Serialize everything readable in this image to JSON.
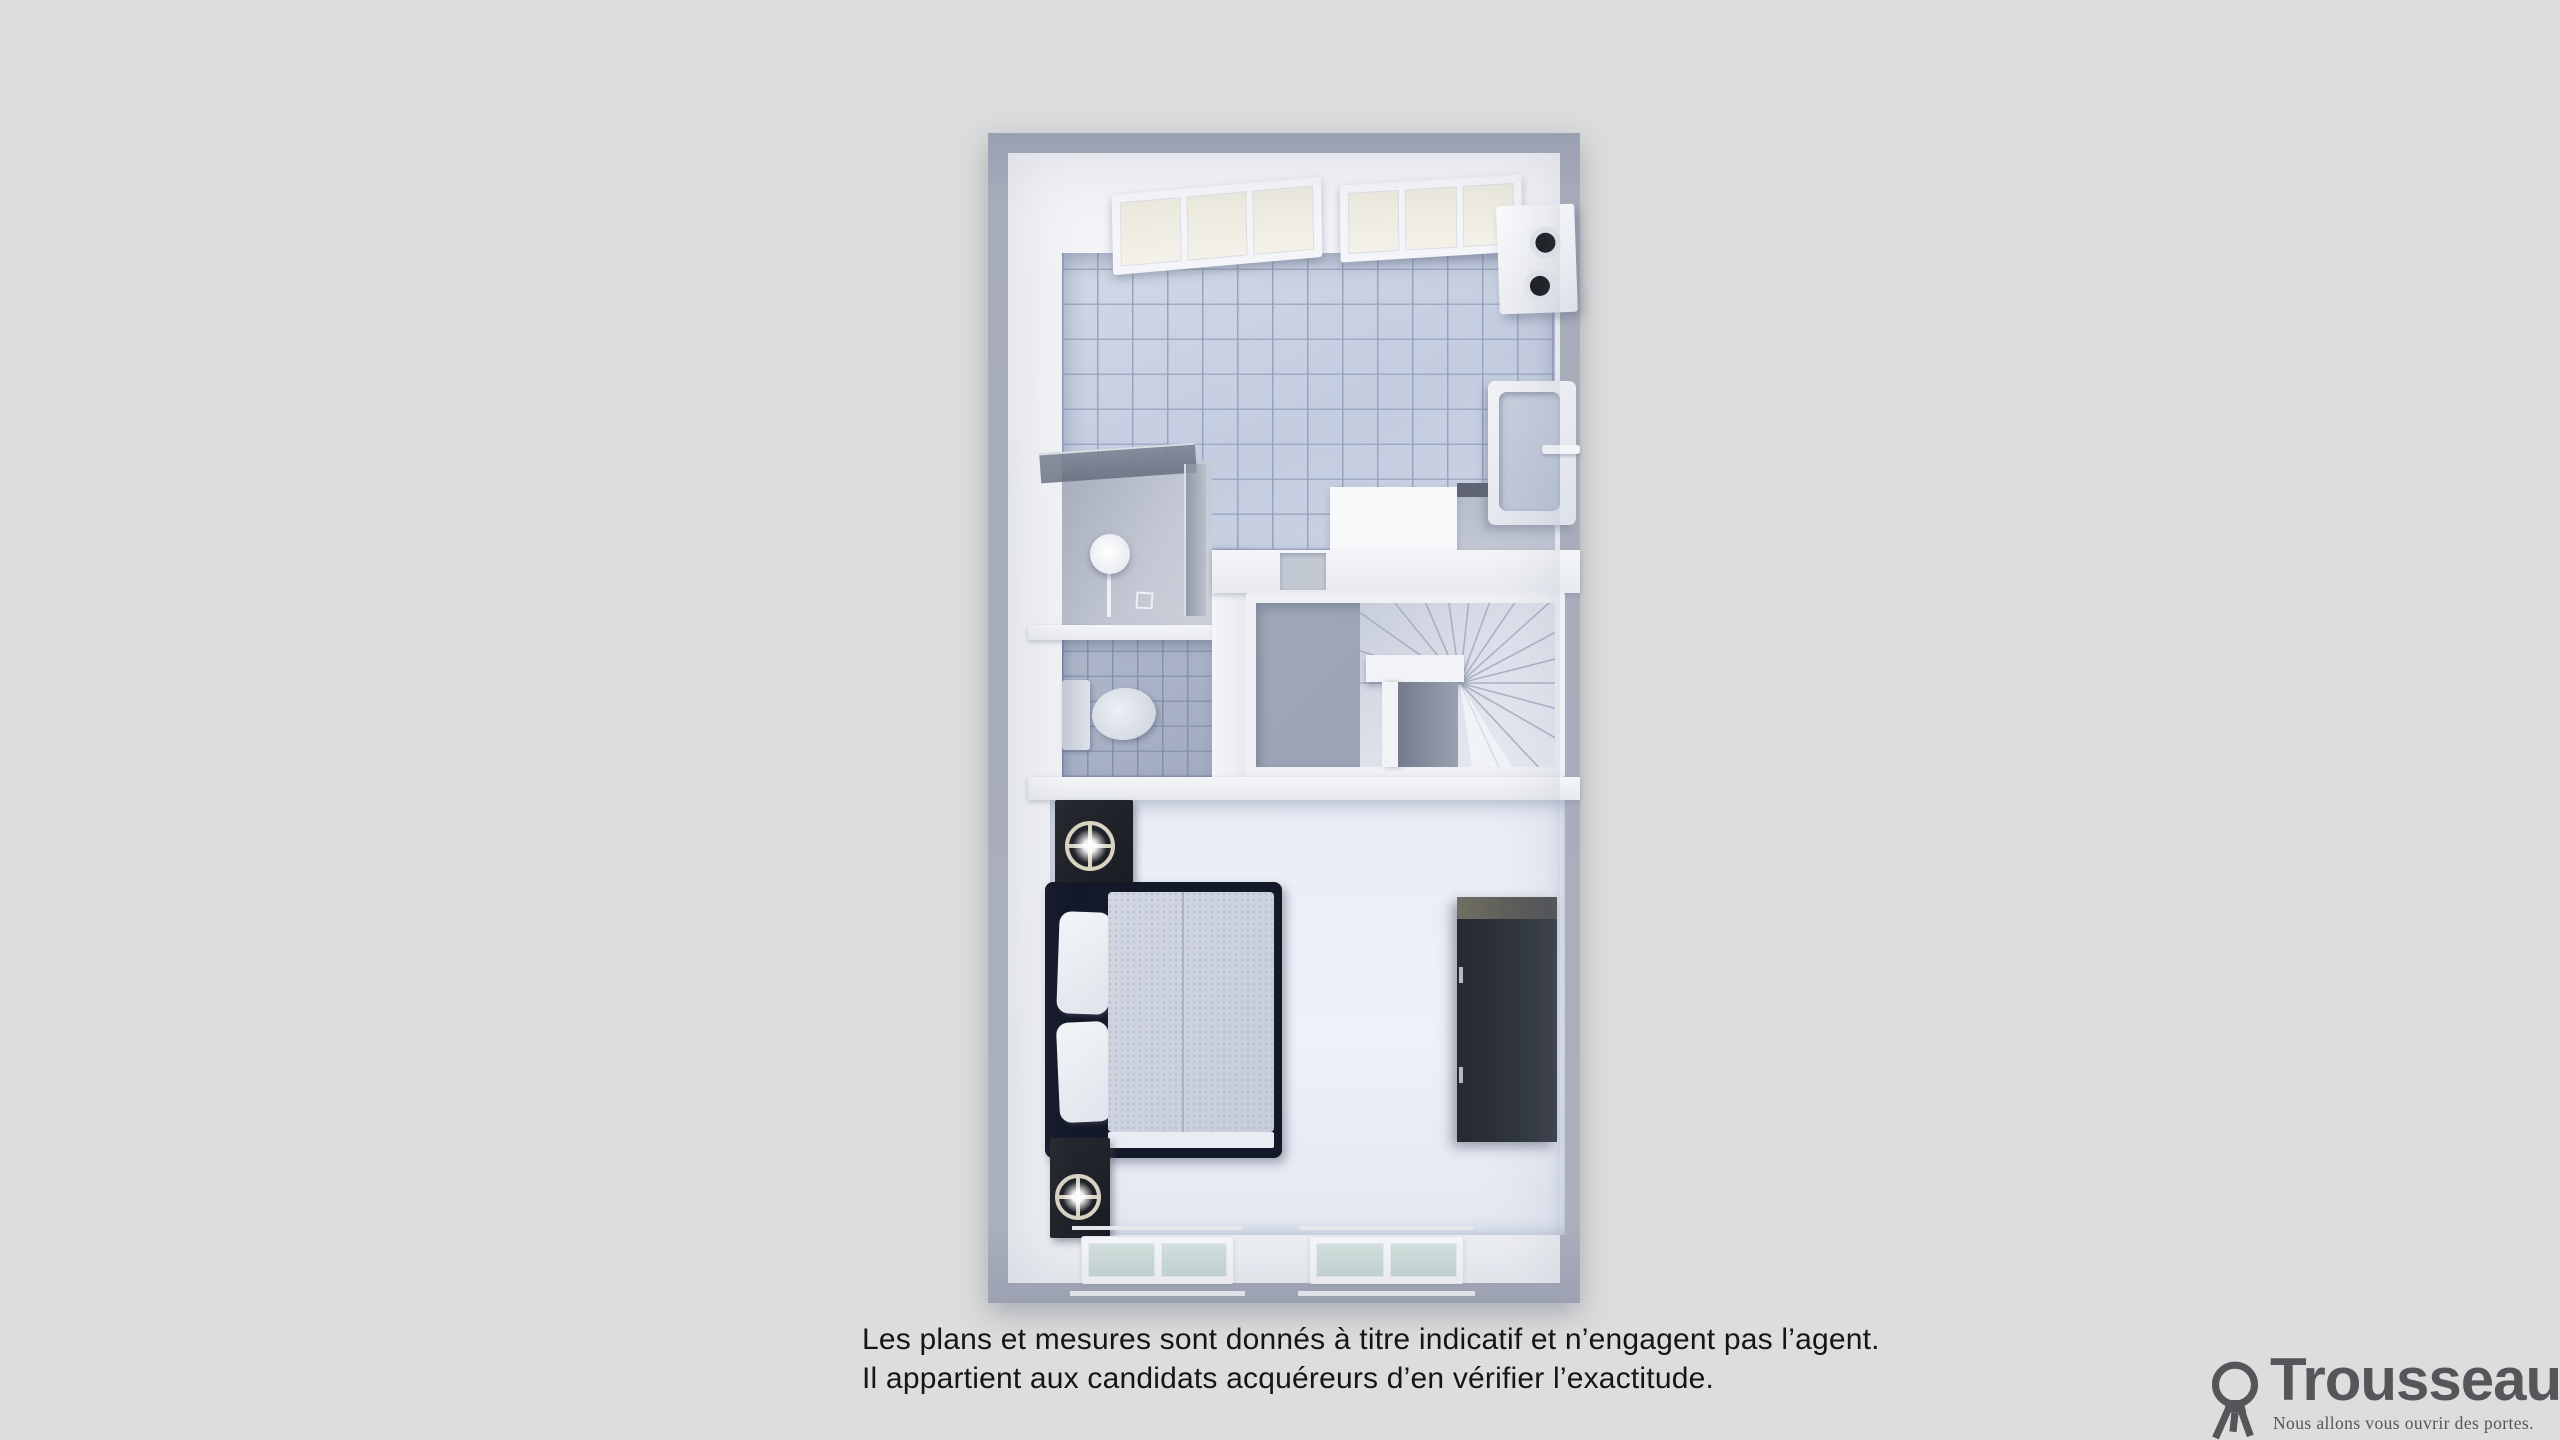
{
  "page": {
    "background_color": "#dcdddd"
  },
  "floorplan": {
    "view": "3d-top-down-floor-plan",
    "outer_wall_color": "#a3a9b8",
    "tile_floor_color": "#c8d0e1",
    "carpet_color": "#9ba4b5",
    "bedroom_floor_color": "#e9edf5",
    "rooms": [
      {
        "name": "bathroom",
        "floor": "light-blue-tiles",
        "features": [
          "skylight-window",
          "skylight-window",
          "water-heater",
          "walk-in-shower",
          "rain-shower-head",
          "shower-glass-panel",
          "wall-hung-sink",
          "storage-box"
        ]
      },
      {
        "name": "wc",
        "floor": "blue-gray-tiles",
        "features": [
          "toilet"
        ]
      },
      {
        "name": "landing",
        "floor": "gray-carpet",
        "features": [
          "winder-staircase",
          "stair-railing",
          "stairwell-void"
        ]
      },
      {
        "name": "bedroom",
        "floor": "pale-wood-white",
        "features": [
          "double-bed",
          "pillows",
          "duvet",
          "nightstand-with-lamp",
          "nightstand-with-lamp",
          "wardrobe",
          "window",
          "window"
        ]
      }
    ]
  },
  "disclaimer": {
    "line1": "Les plans et mesures sont donnés à titre indicatif et n’engagent pas l’agent.",
    "line2": "Il appartient aux candidats acquéreurs d’en vérifier l’exactitude."
  },
  "logo": {
    "brand": "Trousseau",
    "tagline": "Nous allons vous ouvrir des portes.",
    "color": "#55565a"
  }
}
